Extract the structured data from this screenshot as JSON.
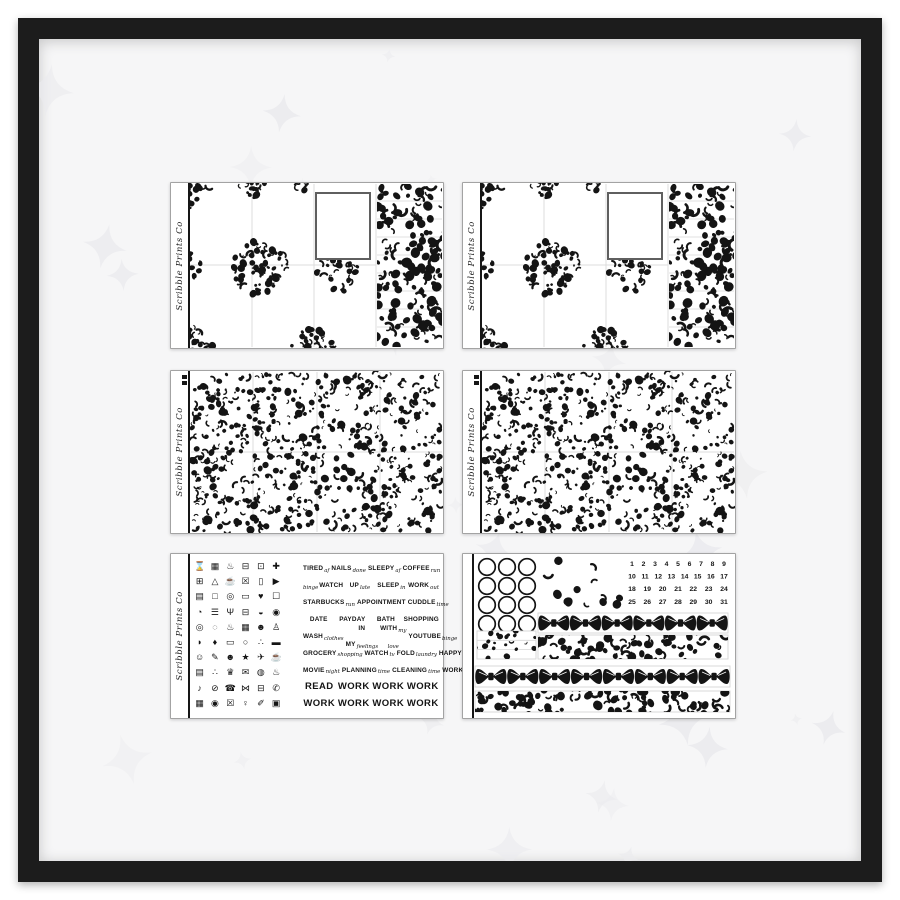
{
  "brand": "Scribble Prints Co",
  "colors": {
    "frame": "#1c1c1c",
    "wall": "#f6f6f7",
    "star": "#ebebee",
    "ink": "#141414",
    "sheet_border": "#a3a3a3",
    "grid_line": "#dcdcdc",
    "strip_line": "#d6d6d6",
    "photo_border": "#5f5f5f"
  },
  "dates": {
    "rows": [
      [
        1,
        2,
        3,
        4,
        5,
        6,
        7,
        8,
        9
      ],
      [
        10,
        11,
        12,
        13,
        14,
        15,
        16,
        17
      ],
      [
        18,
        19,
        20,
        21,
        22,
        23,
        24
      ],
      [
        25,
        26,
        27,
        28,
        29,
        30,
        31
      ]
    ]
  },
  "date_sheet": {
    "circle_grid": {
      "rows": 4,
      "cols": 3
    },
    "bow_strip_small_count": 6,
    "bow_strip_large_count": 8
  },
  "sampler": {
    "icons": [
      {
        "name": "alarm-clock-icon",
        "glyph": "⌛"
      },
      {
        "name": "money-bill-icon",
        "glyph": "▦"
      },
      {
        "name": "lotion-bottle-icon",
        "glyph": "♨"
      },
      {
        "name": "car-icon",
        "glyph": "⊟"
      },
      {
        "name": "note-box-icon",
        "glyph": "⊡"
      },
      {
        "name": "stethoscope-icon",
        "glyph": "✚"
      },
      {
        "name": "photo-frame-icon",
        "glyph": "⊞"
      },
      {
        "name": "mountains-icon",
        "glyph": "△"
      },
      {
        "name": "drink-cup-icon",
        "glyph": "☕"
      },
      {
        "name": "trash-can-icon",
        "glyph": "☒"
      },
      {
        "name": "smartphone-icon",
        "glyph": "▯"
      },
      {
        "name": "play-button-icon",
        "glyph": "▶"
      },
      {
        "name": "calendar-icon",
        "glyph": "▤"
      },
      {
        "name": "television-icon",
        "glyph": "□"
      },
      {
        "name": "purse-icon",
        "glyph": "◎"
      },
      {
        "name": "laptop-icon",
        "glyph": "▭"
      },
      {
        "name": "heart-icon",
        "glyph": "♥"
      },
      {
        "name": "shopping-bag-icon",
        "glyph": "☐"
      },
      {
        "name": "paint-cup-icon",
        "glyph": "◔"
      },
      {
        "name": "bed-icon",
        "glyph": "☰"
      },
      {
        "name": "utensils-icon",
        "glyph": "Ψ"
      },
      {
        "name": "car-side-icon",
        "glyph": "⊟"
      },
      {
        "name": "dish-icon",
        "glyph": "◒"
      },
      {
        "name": "eye-icon",
        "glyph": "◉"
      },
      {
        "name": "target-icon",
        "glyph": "◎"
      },
      {
        "name": "washing-machine-icon",
        "glyph": "◌"
      },
      {
        "name": "cake-icon",
        "glyph": "♨"
      },
      {
        "name": "waffle-icon",
        "glyph": "▦"
      },
      {
        "name": "mickey-ears-icon",
        "glyph": "☻"
      },
      {
        "name": "tooth-icon",
        "glyph": "♙"
      },
      {
        "name": "sneaker-icon",
        "glyph": "◗"
      },
      {
        "name": "ink-drop-icon",
        "glyph": "♦"
      },
      {
        "name": "monitor-icon",
        "glyph": "▭"
      },
      {
        "name": "ring-icon",
        "glyph": "○"
      },
      {
        "name": "family-icon",
        "glyph": "∴"
      },
      {
        "name": "movie-clapper-icon",
        "glyph": "▬"
      },
      {
        "name": "smiley-face-icon",
        "glyph": "☺"
      },
      {
        "name": "pencil-icon",
        "glyph": "✎"
      },
      {
        "name": "grin-face-icon",
        "glyph": "☻"
      },
      {
        "name": "star-icon",
        "glyph": "★"
      },
      {
        "name": "airplane-icon",
        "glyph": "✈"
      },
      {
        "name": "teapot-icon",
        "glyph": "☕"
      },
      {
        "name": "note-paper-icon",
        "glyph": "▤"
      },
      {
        "name": "paw-print-icon",
        "glyph": "∴"
      },
      {
        "name": "trophy-icon",
        "glyph": "♛"
      },
      {
        "name": "envelope-icon",
        "glyph": "✉"
      },
      {
        "name": "honey-jar-icon",
        "glyph": "◍"
      },
      {
        "name": "kettle-icon",
        "glyph": "♨"
      },
      {
        "name": "music-note-icon",
        "glyph": "♪"
      },
      {
        "name": "no-symbol-icon",
        "glyph": "⊘"
      },
      {
        "name": "telephone-icon",
        "glyph": "☎"
      },
      {
        "name": "hair-bow-icon",
        "glyph": "⋈"
      },
      {
        "name": "toaster-icon",
        "glyph": "⊟"
      },
      {
        "name": "hand-phone-icon",
        "glyph": "✆"
      },
      {
        "name": "picnic-basket-icon",
        "glyph": "▦"
      },
      {
        "name": "vinyl-disc-icon",
        "glyph": "◉"
      },
      {
        "name": "bin-icon",
        "glyph": "☒"
      },
      {
        "name": "person-icon",
        "glyph": "♀"
      },
      {
        "name": "needle-icon",
        "glyph": "✐"
      },
      {
        "name": "camera-icon",
        "glyph": "▣"
      }
    ],
    "label_rows": [
      {
        "size": "sm",
        "items": [
          {
            "main": "TIRED",
            "sub": "af"
          },
          {
            "main": "NAILS",
            "sub": "done"
          },
          {
            "main": "SLEEPY",
            "sub": "af"
          },
          {
            "main": "COFFEE",
            "sub": "run"
          }
        ]
      },
      {
        "size": "sm",
        "items": [
          {
            "main": "WATCH",
            "sub": "binge",
            "pre": true
          },
          {
            "main": "UP",
            "sub": "late"
          },
          {
            "main": "SLEEP",
            "sub": "in"
          },
          {
            "main": "WORK",
            "sub": "out"
          }
        ]
      },
      {
        "size": "sm",
        "items": [
          {
            "main": "STARBUCKS",
            "sub": "run"
          },
          {
            "main": "APPOINTMENT",
            "sub": ""
          },
          {
            "main": "CUDDLE",
            "sub": "time"
          }
        ]
      },
      {
        "size": "sm",
        "items": [
          {
            "main": "DATE",
            "sub": ""
          },
          {
            "main": "PAYDAY",
            "sub": ""
          },
          {
            "main": "BATH",
            "sub": ""
          },
          {
            "main": "SHOPPING",
            "sub": ""
          }
        ]
      },
      {
        "size": "sm",
        "items": [
          {
            "main": "WASH",
            "sub": "clothes"
          },
          {
            "main": "IN MY",
            "sub": "feelings"
          },
          {
            "main": "WITH",
            "sub": "my love"
          },
          {
            "main": "YOUTUBE",
            "sub": "binge"
          }
        ]
      },
      {
        "size": "sm",
        "items": [
          {
            "main": "GROCERY",
            "sub": "shopping"
          },
          {
            "main": "WATCH",
            "sub": "tv"
          },
          {
            "main": "FOLD",
            "sub": "laundry"
          },
          {
            "main": "HAPPY",
            "sub": "mail"
          }
        ]
      },
      {
        "size": "sm",
        "items": [
          {
            "main": "MOVIE",
            "sub": "night"
          },
          {
            "main": "PLANNING",
            "sub": "time"
          },
          {
            "main": "CLEANING",
            "sub": "time"
          },
          {
            "main": "WORK",
            "sub": "late"
          }
        ]
      },
      {
        "size": "lg",
        "items": [
          {
            "main": "READ",
            "sub": ""
          },
          {
            "main": "WORK",
            "sub": ""
          },
          {
            "main": "WORK",
            "sub": ""
          },
          {
            "main": "WORK",
            "sub": ""
          }
        ]
      },
      {
        "size": "lg",
        "items": [
          {
            "main": "WORK",
            "sub": ""
          },
          {
            "main": "WORK",
            "sub": ""
          },
          {
            "main": "WORK",
            "sub": ""
          },
          {
            "main": "WORK",
            "sub": ""
          }
        ]
      }
    ]
  }
}
